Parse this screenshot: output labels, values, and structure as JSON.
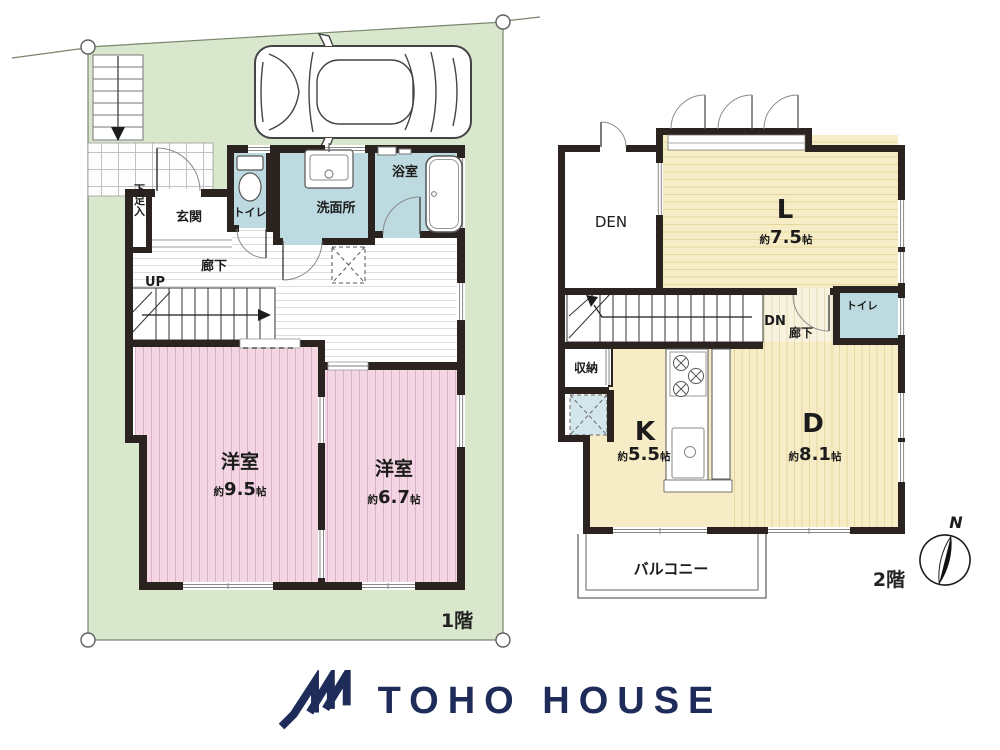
{
  "colors": {
    "lot_green": "#d9e7cd",
    "room_pink": "#f3d6e2",
    "room_yellow": "#f6ecc6",
    "wet_blue": "#bedae1",
    "wall_dark": "#2b2320",
    "brand_navy": "#1f2c5a"
  },
  "floor1": {
    "label": "1階",
    "shoe_closet": "下足入",
    "entrance": "玄関",
    "toilet": "トイレ",
    "washroom": "洗面所",
    "bathroom": "浴室",
    "hallway": "廊下",
    "stairs": "UP",
    "room1_name": "洋室",
    "room1_size_prefix": "約",
    "room1_size_value": "9.5",
    "room1_size_unit": "帖",
    "room2_name": "洋室",
    "room2_size_prefix": "約",
    "room2_size_value": "6.7",
    "room2_size_unit": "帖"
  },
  "floor2": {
    "label": "2階",
    "den": "DEN",
    "living_name": "L",
    "living_size_prefix": "約",
    "living_size_value": "7.5",
    "living_size_unit": "帖",
    "toilet": "トイレ",
    "stairs": "DN",
    "hallway": "廊下",
    "storage": "収納",
    "kitchen_name": "K",
    "kitchen_size_prefix": "約",
    "kitchen_size_value": "5.5",
    "kitchen_size_unit": "帖",
    "dining_name": "D",
    "dining_size_prefix": "約",
    "dining_size_value": "8.1",
    "dining_size_unit": "帖",
    "balcony": "バルコニー",
    "compass_north": "N"
  },
  "footer": {
    "brand": "TOHO HOUSE"
  }
}
